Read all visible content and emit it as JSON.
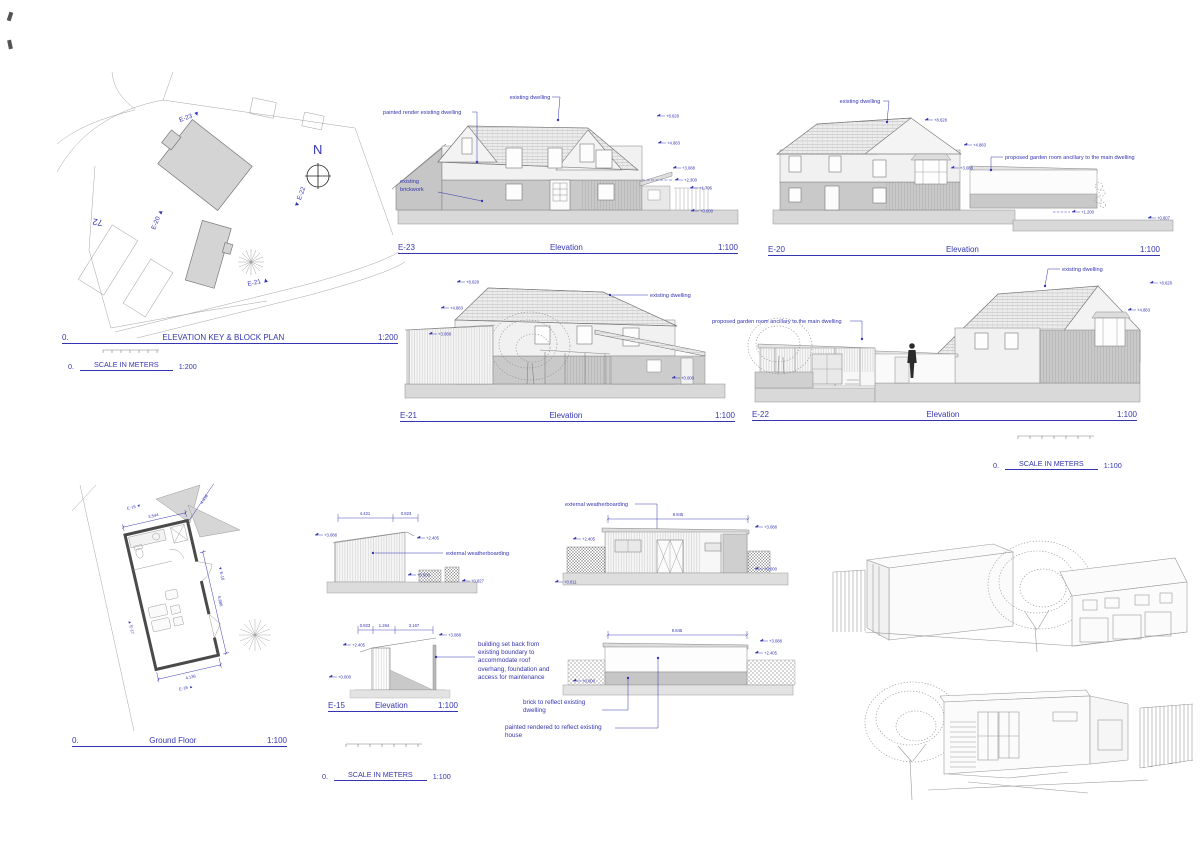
{
  "block_plan": {
    "no": "0.",
    "title": "ELEVATION KEY & BLOCK PLAN",
    "scale": "1:200",
    "scale_no": "0.",
    "scale_label": "SCALE IN METERS",
    "scale_ratio": "1:200",
    "north": "N",
    "house_number": "72",
    "marker_e23": "E-23 ▼",
    "marker_e22": "▼ E-22",
    "marker_e20": "E-20 ▲",
    "marker_e21": "E-21 ▲"
  },
  "e23": {
    "id": "E-23",
    "title": "Elevation",
    "scale": "1:100",
    "label_existing_dwelling": "existing dwelling",
    "label_painted_render": "painted render existing dwelling",
    "label_brick_1": "existing",
    "label_brick_2": "brickwork",
    "levels": [
      "+8.628",
      "+4.883",
      "+3.088",
      "+2.300",
      "+1.706",
      "+0.000"
    ]
  },
  "e20": {
    "id": "E-20",
    "title": "Elevation",
    "scale": "1:100",
    "label_existing_dwelling": "existing dwelling",
    "label_garden_room": "proposed garden room ancillary to the main dwelling",
    "levels": [
      "+8.628",
      "+4.883",
      "+3.088",
      "+1.200",
      "+0.807"
    ]
  },
  "e21": {
    "id": "E-21",
    "title": "Elevation",
    "scale": "1:100",
    "label_existing_dwelling": "existing dwelling",
    "levels": [
      "+8.628",
      "+4.883",
      "+3.088",
      "+0.000"
    ]
  },
  "e22": {
    "id": "E-22",
    "title": "Elevation",
    "scale": "1:100",
    "label_existing_dwelling": "existing dwelling",
    "label_garden_room": "proposed garden room ancillary to the main dwelling",
    "levels": [
      "+8.628",
      "+4.883"
    ]
  },
  "scale_upper": {
    "no": "0.",
    "label": "SCALE IN METERS",
    "ratio": "1:100"
  },
  "ground_floor": {
    "no": "0.",
    "title": "Ground Floor",
    "scale": "1:100",
    "marker_e15": "E-15 ▼",
    "marker_e16": "▼ E-16",
    "marker_e17": "▲ E-17",
    "marker_e18": "E-18 ▲",
    "dim_top": "3.544",
    "dim_diag": "4.436",
    "dim_right": "6.886",
    "dim_bottom": "4.136"
  },
  "e15": {
    "id": "E-15",
    "title": "Elevation",
    "scale": "1:100",
    "label_weatherboarding": "external weatherboarding",
    "top_dims": [
      "4.421",
      "0.823"
    ],
    "top_levels": [
      "+3.088",
      "+2.405",
      "+0.000",
      "+0.827"
    ],
    "sec_dims": [
      "0.823",
      "1.264",
      "3.167"
    ],
    "sec_levels": [
      "+3.088",
      "+2.405",
      "+0.000"
    ],
    "note_lines": [
      "building set back from",
      "existing boundary to",
      "accommodate roof",
      "overhang, foundation and",
      "access for maintenance"
    ]
  },
  "garden_front": {
    "label_weatherboarding": "external weatherboarding",
    "dim": "9.845",
    "levels": [
      "+3.088",
      "+2.405",
      "+0.000",
      "+0.811"
    ]
  },
  "garden_rear": {
    "dim": "9.845",
    "levels": [
      "+3.088",
      "+2.405",
      "+0.000"
    ],
    "note_brick_1": "brick to reflect existing",
    "note_brick_2": "dwelling",
    "note_render": "painted rendered to reflect existing house"
  },
  "scale_lower": {
    "no": "0.",
    "label": "SCALE IN METERS",
    "ratio": "1:100"
  }
}
